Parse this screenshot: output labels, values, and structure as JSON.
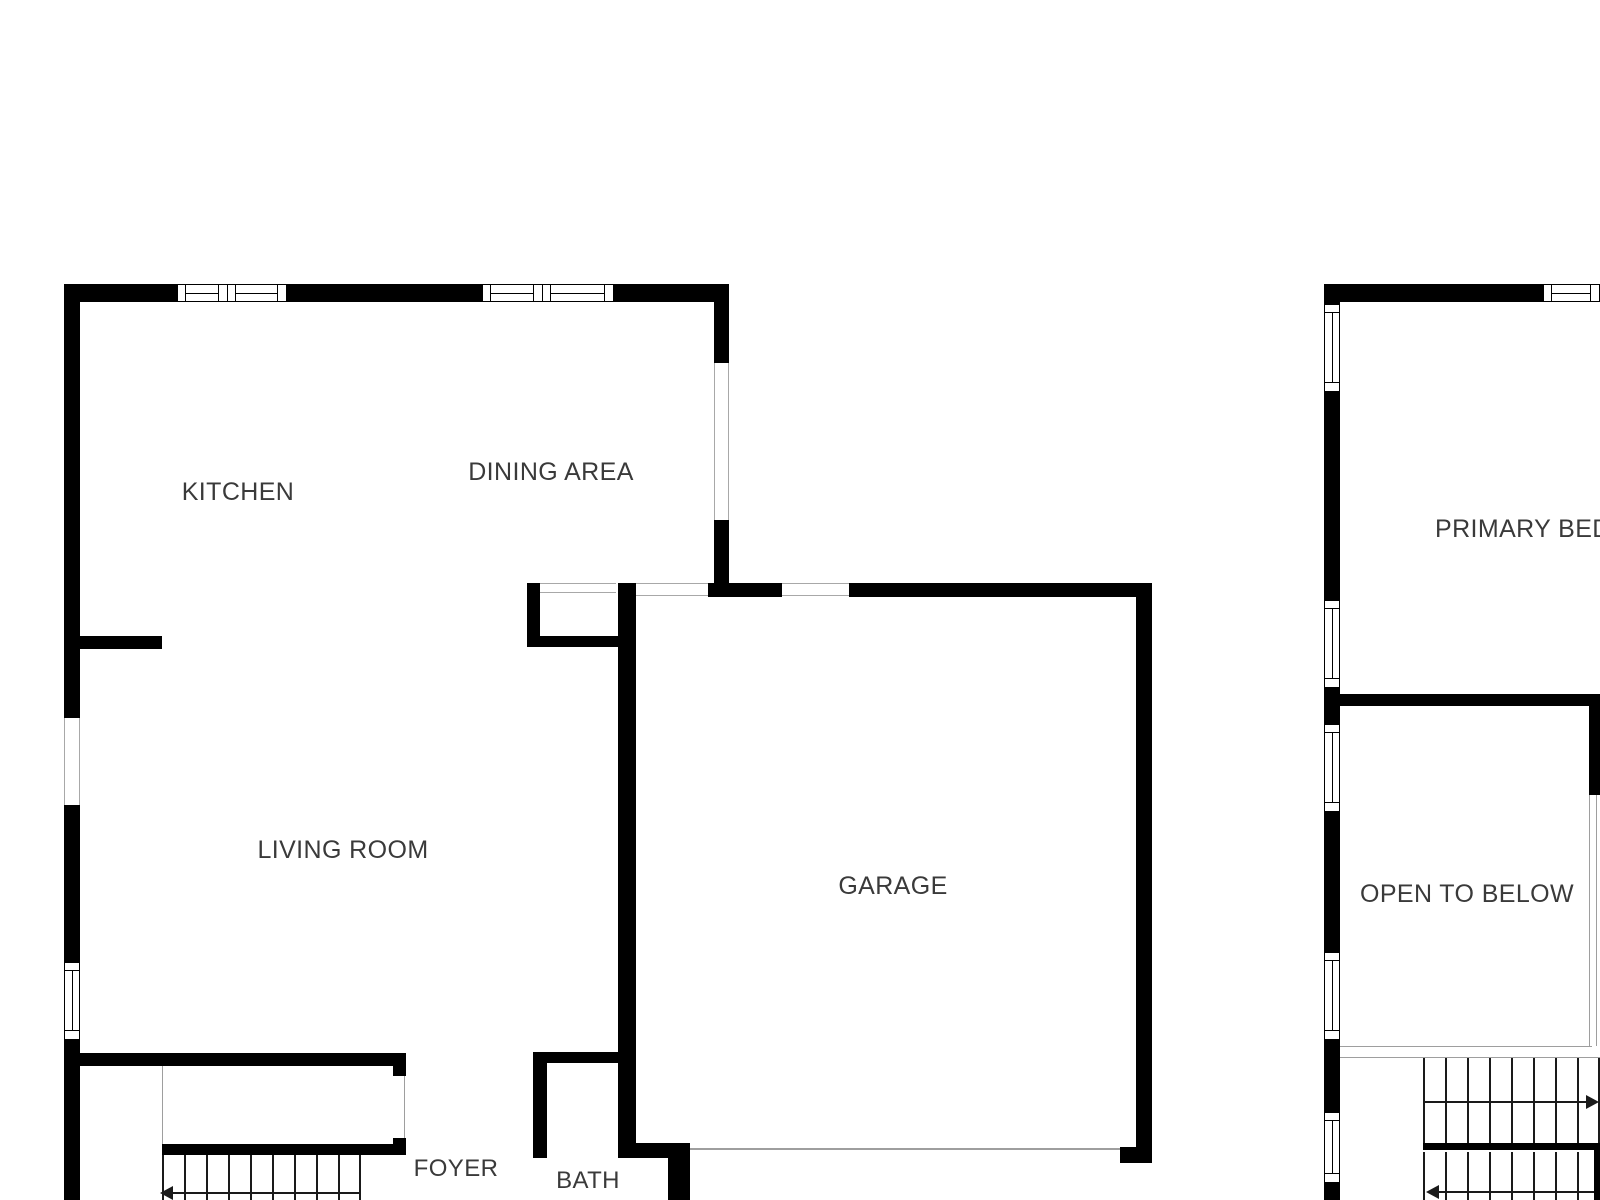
{
  "colors": {
    "background": "#ffffff",
    "wall": "#000000",
    "label_text": "#3a3a3a",
    "thin_line": "#9e9e9e",
    "stair_line": "#1a1a1a"
  },
  "labels": {
    "kitchen": "KITCHEN",
    "dining_area": "DINING AREA",
    "living_room": "LIVING ROOM",
    "garage": "GARAGE",
    "foyer": "FOYER",
    "bath": "BATH",
    "primary_bedroom": "PRIMARY BEDROOM",
    "open_to_below": "OPEN TO BELOW"
  },
  "stairs": {
    "left_unit_arrow_direction": "left",
    "right_unit_upper_arrow_direction": "right",
    "right_unit_lower_arrow_direction": "left"
  }
}
